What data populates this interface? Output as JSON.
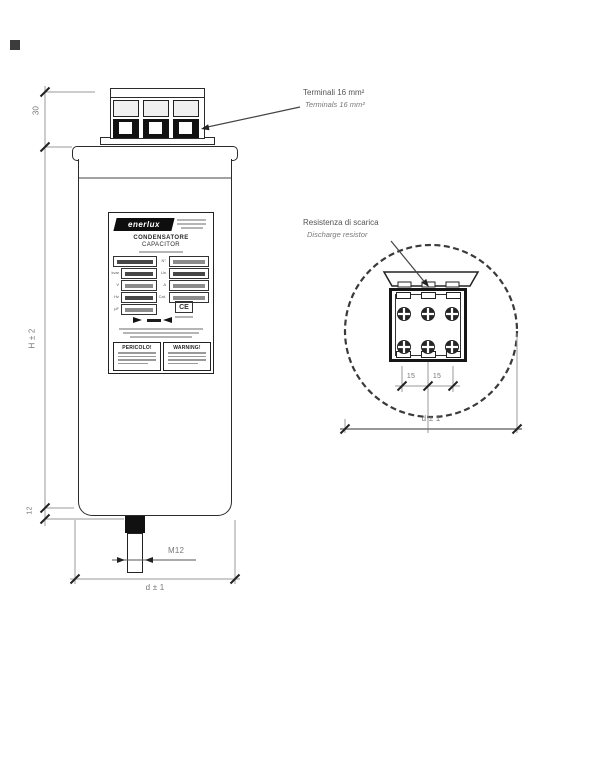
{
  "annotations": {
    "terminals_note_it": "Terminali 16 mm²",
    "terminals_note_en": "Terminals 16 mm²",
    "discharge_note_it": "Resistenza di scarica",
    "discharge_note_en": "Discharge resistor"
  },
  "dimensions": {
    "terminal_height": "30",
    "body_height": "H ± 2",
    "stud_length": "12",
    "stud_thread": "M12",
    "front_width": "d ± 1",
    "top_diameter": "d ± 1",
    "terminal_pitch_left": "15",
    "terminal_pitch_right": "15"
  },
  "nameplate": {
    "brand": "enerlux",
    "product_it": "CONDENSATORE",
    "product_en": "CAPACITOR",
    "fields_left": [
      "TIPO",
      "kvar",
      "V",
      "Hz",
      "µF"
    ],
    "fields_right": [
      "N°",
      "Un",
      "A",
      "Cat."
    ],
    "ce_mark": "CE",
    "danger_title": "PERICOLO!",
    "warning_title": "WARNING!"
  },
  "colors": {
    "line": "#2b2b2b",
    "dim_line": "#999999",
    "dim_text": "#777777",
    "fill_dark": "#111111"
  }
}
